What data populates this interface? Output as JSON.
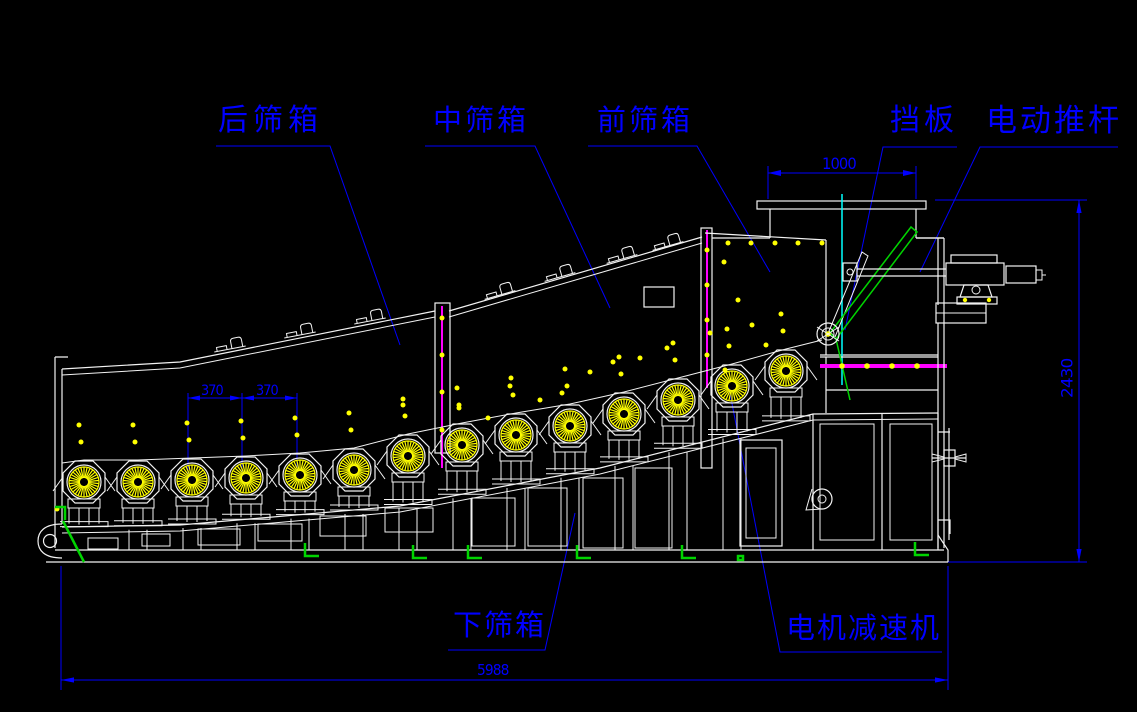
{
  "drawing_type": "CAD side-view drawing of a roller screening machine",
  "labels": {
    "rear_screen_box": "后筛箱",
    "middle_screen_box": "中筛箱",
    "front_screen_box": "前筛箱",
    "baffle": "挡板",
    "electric_push_rod": "电动推杆",
    "lower_screen_box": "下筛箱",
    "motor_reducer": "电机减速机"
  },
  "dimensions": {
    "hopper_width": "1000",
    "overall_height": "2430",
    "roller_spacing_1": "370",
    "roller_spacing_2": "370",
    "overall_length": "5988"
  },
  "colors": {
    "bg": "#000000",
    "white": "#f2f2f2",
    "blue": "#0000ff",
    "yellow": "#ffff00",
    "magenta": "#ff00ff",
    "cyan": "#00ffff",
    "green": "#00d400"
  },
  "icons": {
    "roller_wheel": "sunburst-roller-icon",
    "handwheel": "handwheel-icon"
  }
}
